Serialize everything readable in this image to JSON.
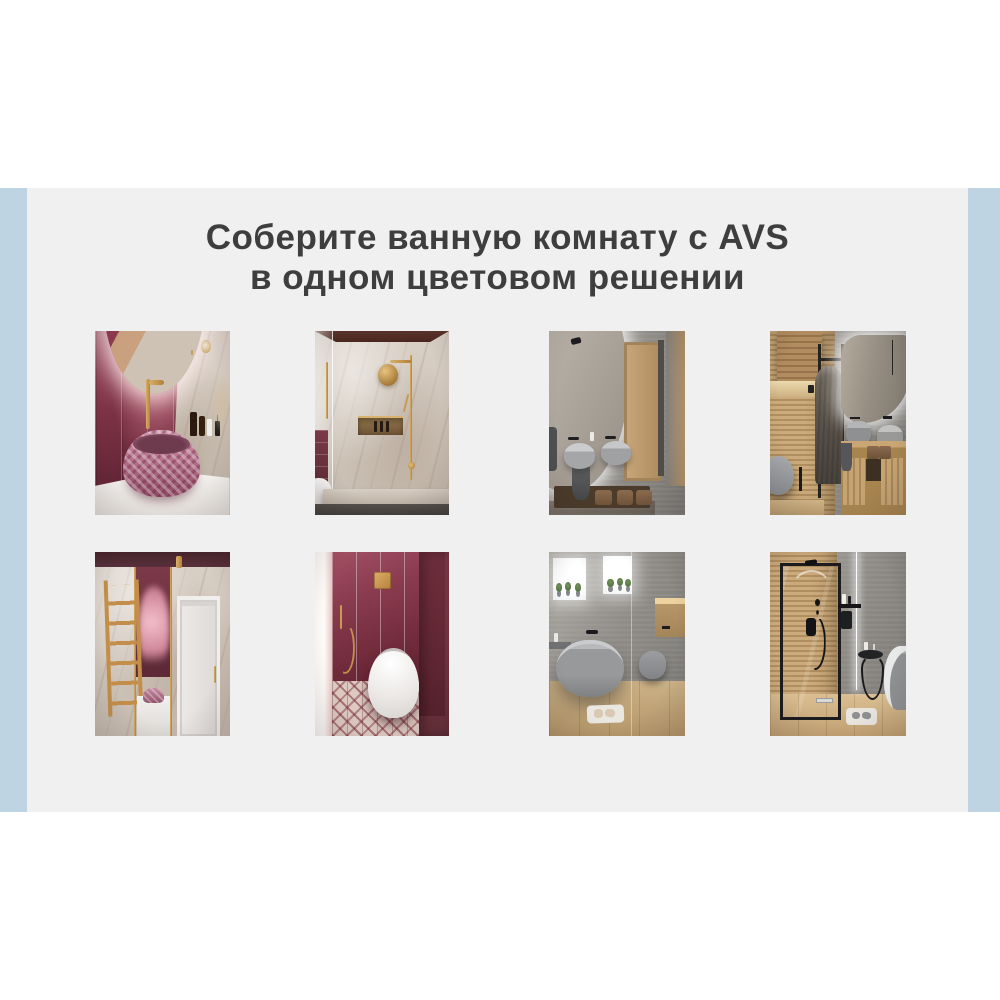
{
  "theme": {
    "band": "#bfd4e2",
    "card": "#f0f0f1",
    "ink": "#3e3e3e",
    "gold": "#c28e49",
    "burgundy": "#7c2d3d",
    "grey": "#8b8d90",
    "wood": "#c2a274"
  },
  "header": {
    "brand": "AVS",
    "title_line1": "Соберите ванную комнату с AVS",
    "title_line2": "в одном цветовом решении"
  }
}
